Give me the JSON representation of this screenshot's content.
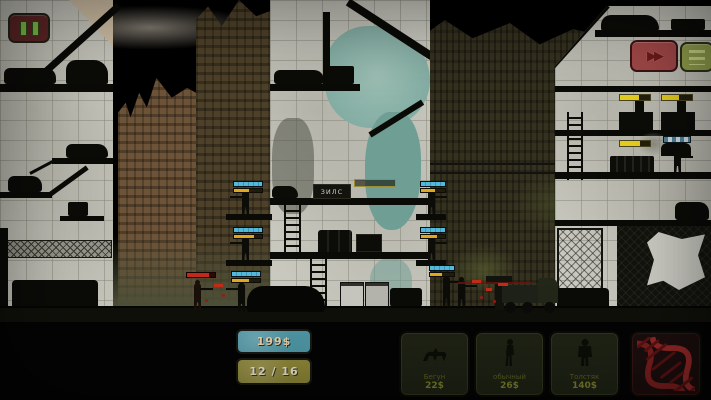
{
  "hud": {
    "pause_icon": "pause-icon",
    "fast_forward_icon": "▶▶",
    "menu_icon": "list-icon",
    "money": "199$",
    "unit_count": "12 / 16"
  },
  "scene": {
    "billboard_text": "ЗИЛС"
  },
  "shop": {
    "cards": [
      {
        "label": "Бегун",
        "price": "22$",
        "icon": "runner-zombie-icon"
      },
      {
        "label": "обычный",
        "price": "26$",
        "icon": "walker-zombie-icon"
      },
      {
        "label": "Толстяк",
        "price": "140$",
        "icon": "brute-zombie-icon"
      },
      {
        "label": "",
        "price": "",
        "icon": "dna-helix-icon"
      }
    ]
  },
  "colors": {
    "money_badge": "#4f97a6",
    "count_badge": "#918a39",
    "pause_button": "#5e2626",
    "fast_forward_button": "#a34848",
    "menu_button": "#94a24e",
    "hp_bar": "#52b9da",
    "enemy_hp_bar": "#c3281a",
    "machine_hp_bar": "#e7cf1d"
  }
}
